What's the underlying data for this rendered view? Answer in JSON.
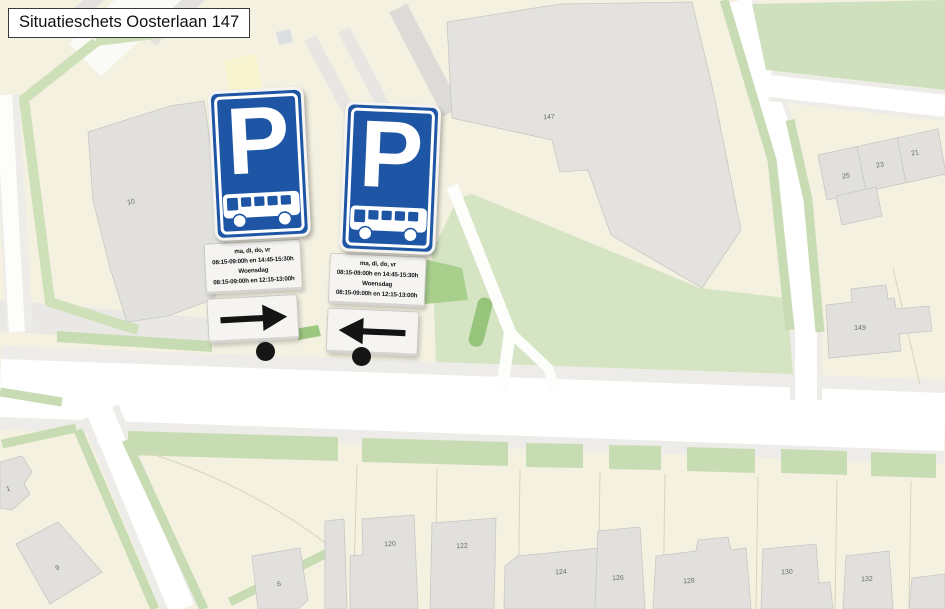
{
  "title": "Situatieschets Oosterlaan 147",
  "signs": [
    {
      "id": "east-sign",
      "symbol": "P",
      "schedule": [
        "ma, di, do, vr",
        "08:15-09:00h en 14:45-15:30h",
        "Woensdag",
        "08:15-09:00h en 12:15-13:00h"
      ],
      "arrow": "right"
    },
    {
      "id": "west-sign",
      "symbol": "P",
      "schedule": [
        "ma, di, do, vr",
        "08:15-09:00h en 14:45-15:30h",
        "Woensdag",
        "08:15-09:00h en 12:15-13:00h"
      ],
      "arrow": "left"
    }
  ],
  "houses": {
    "h10": "10",
    "h147": "147",
    "h25": "25",
    "h23": "23",
    "h21": "21",
    "h149": "149",
    "h120": "120",
    "h122": "122",
    "h124": "124",
    "h126": "126",
    "h128": "128",
    "h130": "130",
    "h132": "132",
    "h1": "1",
    "h9": "9",
    "h6": "6"
  },
  "colors": {
    "sign_blue": "#1e56a5",
    "arrow_black": "#141414",
    "map_cream": "#f4f1e1",
    "map_green_light": "#d5e4c3",
    "map_green_verge": "#c8dcb3",
    "map_green_hedge": "#96c47a",
    "road_white": "#ffffff",
    "building_gray": "#e1e0dd"
  }
}
